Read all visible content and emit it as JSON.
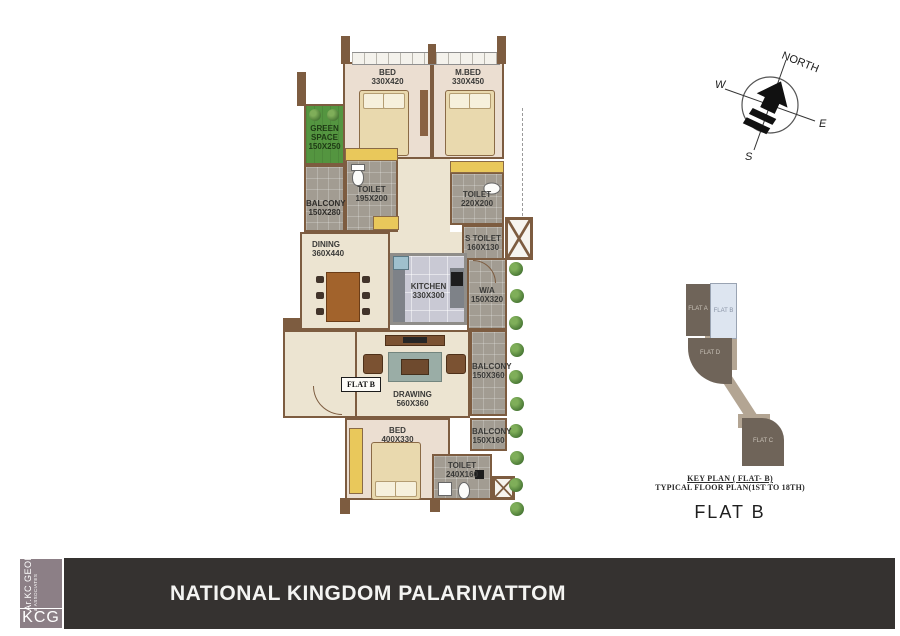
{
  "plan": {
    "flat_label": "FLAT B",
    "rooms": [
      {
        "name": "BED",
        "dims": "330X420"
      },
      {
        "name": "M.BED",
        "dims": "330X450"
      },
      {
        "name": "GREEN SPACE",
        "dims": "150X250"
      },
      {
        "name": "BALCONY",
        "dims": "150X280"
      },
      {
        "name": "TOILET",
        "dims": "195X200"
      },
      {
        "name": "TOILET",
        "dims": "220X200"
      },
      {
        "name": "S TOILET",
        "dims": "160X130"
      },
      {
        "name": "DINING",
        "dims": "360X440"
      },
      {
        "name": "KITCHEN",
        "dims": "330X300"
      },
      {
        "name": "W/A",
        "dims": "150X320"
      },
      {
        "name": "DRAWING",
        "dims": "560X360"
      },
      {
        "name": "BALCONY",
        "dims": "150X360"
      },
      {
        "name": "BED",
        "dims": "400X330"
      },
      {
        "name": "BALCONY",
        "dims": "150X160"
      },
      {
        "name": "TOILET",
        "dims": "240X160"
      }
    ]
  },
  "compass": {
    "north": "NORTH",
    "west": "W",
    "east": "E",
    "south": "S"
  },
  "key_plan": {
    "flat_a": "FLAT A",
    "flat_b": "FLAT B",
    "flat_d": "FLAT D",
    "flat_c": "FLAT C",
    "caption1": "KEY PLAN ( FLAT- B)",
    "caption2": "TYPICAL FLOOR PLAN(1ST TO 18TH)",
    "title": "FLAT B"
  },
  "footer": {
    "project_title": "NATIONAL KINGDOM PALARIVATTOM"
  },
  "logo": {
    "mark": "KCG",
    "firm": "Ar.KC GEORGE",
    "suffix": "& ASSOCIATES"
  },
  "colors": {
    "wall": "#7d5c40",
    "floor_cream": "#ece4d1",
    "tile_gray": "#a29c92",
    "kitchen_floor": "#c9c9d4",
    "green_space": "#549540",
    "accent_yellow": "#e9c85b",
    "footer_bar": "#353230",
    "logo_bg": "#8c7f86",
    "keyplan_dark": "#6f6459",
    "keyplan_flatb": "#dde5f0",
    "keyplan_tan": "#b3a593"
  }
}
